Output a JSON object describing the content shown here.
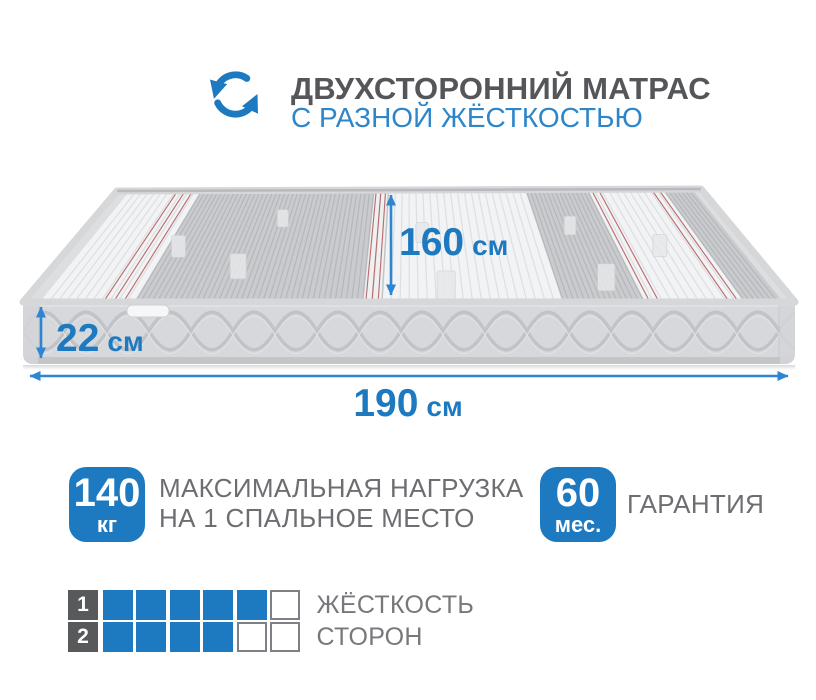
{
  "header": {
    "icon": "rotate-arrows-icon",
    "title": "ДВУХСТОРОННИЙ МАТРАС",
    "subtitle": "С РАЗНОЙ ЖЁСТКОСТЬЮ"
  },
  "mattress": {
    "width_label": {
      "value": "160",
      "unit": "см"
    },
    "thickness_label": {
      "value": "22",
      "unit": "см"
    },
    "length_label": {
      "value": "190",
      "unit": "см"
    }
  },
  "features": [
    {
      "value": "140",
      "unit": "кг",
      "lines": [
        "МАКСИМАЛЬНАЯ НАГРУЗКА",
        "НА 1 СПАЛЬНОЕ МЕСТО"
      ]
    },
    {
      "value": "60",
      "unit": "мес.",
      "lines": [
        "ГАРАНТИЯ"
      ]
    }
  ],
  "ratings": {
    "rows": [
      {
        "number": "1",
        "filled": 5,
        "total": 6,
        "label": "ЖЁСТКОСТЬ"
      },
      {
        "number": "2",
        "filled": 4,
        "total": 6,
        "label": "СТОРОН"
      }
    ]
  },
  "colors": {
    "accent_blue": "#1d79c0",
    "subtitle_blue": "#2e86ca",
    "arrow_blue": "#2e86d2",
    "title_gray": "#55565a",
    "text_gray": "#6d6e71",
    "label_gray": "#77787b",
    "square_dark": "#58595b",
    "square_border": "#7d8084"
  }
}
